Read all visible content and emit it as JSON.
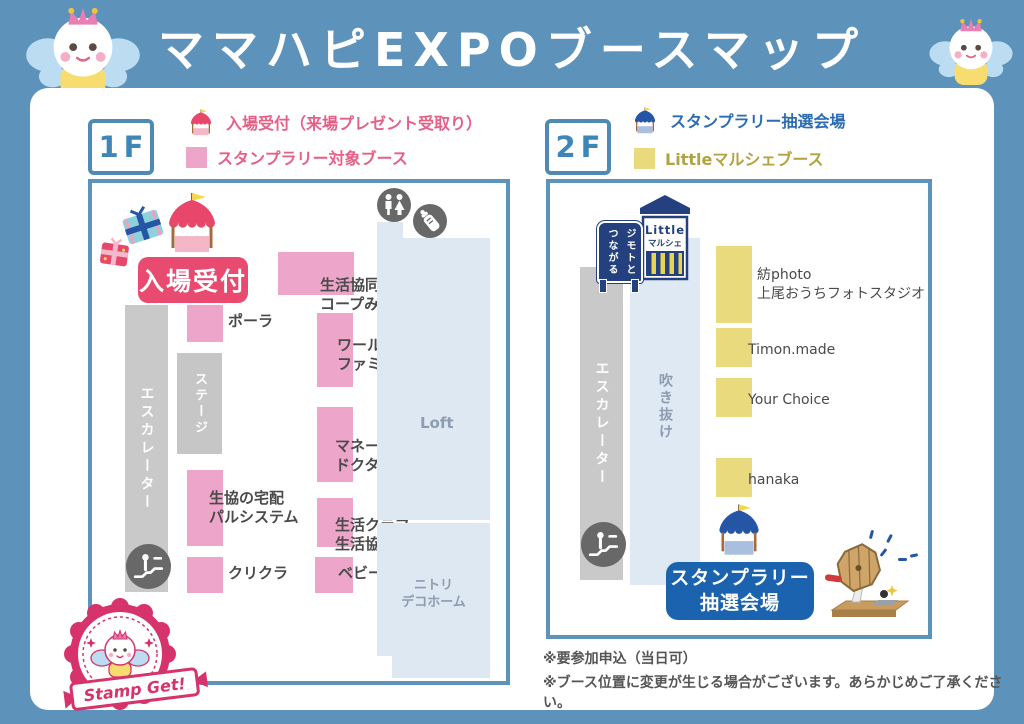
{
  "header": {
    "title": "ママハピEXPOブースマップ"
  },
  "floor1": {
    "label": "1F",
    "legend": [
      {
        "icon": "pink-tent-icon",
        "label": "入場受付（来場プレゼント受取り）"
      },
      {
        "icon": "pink-square",
        "label": "スタンプラリー対象ブース"
      }
    ],
    "entrance_label": "入場受付",
    "escalator_label": "エスカレーター",
    "stage_label": "ステージ",
    "loft_label": "Loft",
    "nitori_label": "ニトリ\nデコホーム",
    "booths": {
      "pola": "ポーラ",
      "coop_mirai": "生活協同組合\nコープみらい",
      "world_family": "ワールド・\nファミリー（株）",
      "money_doctor": "マネー\nドクター",
      "pal_system": "生協の宅配\nパルシステム",
      "seikatsu_club": "生活クラブ\n生活協同組合",
      "crecla": "クリクラ",
      "baby_park": "ベビーパーク"
    },
    "stamp_badge_label": "Stamp Get!"
  },
  "floor2": {
    "label": "2F",
    "legend": [
      {
        "icon": "blue-tent-icon",
        "label": "スタンプラリー抽選会場"
      },
      {
        "icon": "yellow-square",
        "label": "Littleマルシェブース"
      }
    ],
    "little_sign": {
      "line1": "Little",
      "line2": "マルシェ"
    },
    "jimoto_sign": "ジモトと\nつながる",
    "escalator_label": "エスカレーター",
    "atrium_label": "吹き抜け",
    "booths": {
      "tsumugi_photo": "紡photo\n上尾おうちフォトスタジオ",
      "timon_made": "Timon.made",
      "your_choice": "Your Choice",
      "hanaka": "hanaka"
    },
    "lottery_label": "スタンプラリー\n抽選会場"
  },
  "notes": [
    "※要参加申込（当日可）",
    "※ブース位置に変更が生じる場合がございます。あらかじめご了承ください。"
  ],
  "colors": {
    "frame_blue": "#5d92ba",
    "booth_pink": "#eda6c9",
    "booth_yellow": "#e9da7e",
    "entrance_red": "#e84a70",
    "legend_pink_text": "#e85f86",
    "legend_blue_text": "#2d6cb3",
    "legend_olive_text": "#b1a33f",
    "navy": "#24407e",
    "lottery_blue": "#1b63ae",
    "area_lightblue": "#dde8f3",
    "gray_area": "#c9c9c9",
    "badge_crimson": "#d6336c"
  }
}
